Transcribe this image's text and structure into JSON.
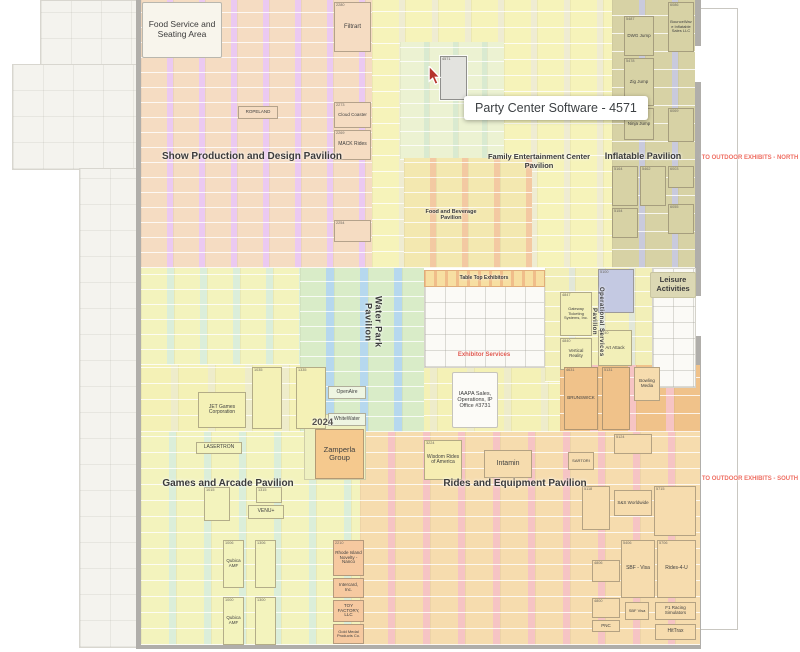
{
  "tooltip": {
    "text": "Party Center Software - 4571"
  },
  "colors": {
    "outdoor_label_red": "#ef6f63",
    "exhibitor_services_red": "#e05a50",
    "wall_gray": "#b0aeaa",
    "selected_booth": "#e3e3df",
    "tooltip_bg": "#ffffff"
  },
  "structure": {
    "concourse": [
      {
        "x": 40,
        "y": 0,
        "w": 98,
        "h": 66
      },
      {
        "x": 12,
        "y": 64,
        "w": 126,
        "h": 106
      },
      {
        "x": 79,
        "y": 168,
        "w": 59,
        "h": 480
      }
    ],
    "walls": [
      {
        "x": 136,
        "y": 0,
        "w": 5,
        "h": 649
      },
      {
        "x": 695,
        "y": 0,
        "w": 6,
        "h": 649
      },
      {
        "x": 136,
        "y": 644,
        "w": 565,
        "h": 5
      }
    ],
    "doors": [
      {
        "x": 695,
        "y": 46,
        "w": 6,
        "h": 36
      },
      {
        "x": 676,
        "y": 46,
        "w": 19,
        "h": 36
      },
      {
        "x": 695,
        "y": 296,
        "w": 6,
        "h": 40
      }
    ],
    "lines": [
      {
        "x": 737,
        "y": 8,
        "w": 1,
        "h": 622
      },
      {
        "x": 701,
        "y": 8,
        "w": 36,
        "h": 1
      },
      {
        "x": 701,
        "y": 629,
        "w": 36,
        "h": 1
      }
    ]
  },
  "regions": [
    {
      "id": "show-production-design",
      "x": 141,
      "y": 0,
      "w": 231,
      "h": 268,
      "bg": "#ebc9f1",
      "booth": "#f5dcc2",
      "cw": 26,
      "gap": 6,
      "rh": 15
    },
    {
      "id": "family-entertainment",
      "x": 372,
      "y": 0,
      "w": 240,
      "h": 268,
      "bg": "#efecd2",
      "booth": "#f6f3ba",
      "cw": 27,
      "gap": 6,
      "rh": 16
    },
    {
      "id": "fec-green",
      "x": 400,
      "y": 42,
      "w": 104,
      "h": 118,
      "bg": "#d9ead0",
      "booth": "#ecf2d2",
      "cw": 24,
      "gap": 5,
      "rh": 14
    },
    {
      "id": "inflatable",
      "x": 612,
      "y": 0,
      "w": 83,
      "h": 268,
      "bg": "#c9cadc",
      "booth": "#d7d2a5",
      "cw": 27,
      "gap": 6,
      "rh": 18
    },
    {
      "id": "food-beverage",
      "x": 404,
      "y": 158,
      "w": 128,
      "h": 110,
      "bg": "#f3c9a2",
      "booth": "#f3e8b0",
      "cw": 26,
      "gap": 6,
      "rh": 15
    },
    {
      "id": "games-upper",
      "x": 141,
      "y": 268,
      "w": 159,
      "h": 97,
      "bg": "#dbeeda",
      "booth": "#f3f3bd",
      "cw": 26,
      "gap": 7,
      "rh": 15
    },
    {
      "id": "mid-yellow-band",
      "x": 141,
      "y": 365,
      "w": 419,
      "h": 67,
      "bg": "#eeecca",
      "booth": "#f4f1b6",
      "cw": 30,
      "gap": 7,
      "rh": 16
    },
    {
      "id": "water-park",
      "x": 300,
      "y": 268,
      "w": 124,
      "h": 164,
      "bg": "#b6d8ee",
      "booth": "#d9ecc8",
      "cw": 26,
      "gap": 8,
      "rh": 15
    },
    {
      "id": "operational-services",
      "x": 545,
      "y": 268,
      "w": 107,
      "h": 114,
      "bg": "#e2e7d8",
      "booth": "#f2efb8",
      "cw": 24,
      "gap": 6,
      "rh": 15
    },
    {
      "id": "rides-upper-right",
      "x": 560,
      "y": 365,
      "w": 140,
      "h": 67,
      "bg": "#f6c4c4",
      "booth": "#f0c28a",
      "cw": 30,
      "gap": 8,
      "rh": 18
    },
    {
      "id": "games-arcade",
      "x": 141,
      "y": 432,
      "w": 219,
      "h": 213,
      "bg": "#dbeeda",
      "booth": "#f3f3bd",
      "cw": 28,
      "gap": 7,
      "rh": 16
    },
    {
      "id": "rides-equipment",
      "x": 360,
      "y": 432,
      "w": 340,
      "h": 213,
      "bg": "#f6c4c4",
      "booth": "#f6dcae",
      "cw": 28,
      "gap": 7,
      "rh": 16
    }
  ],
  "white_areas": [
    {
      "id": "exhibitor-services-plan",
      "cls": "plan-area",
      "x": 424,
      "y": 270,
      "w": 121,
      "h": 98
    },
    {
      "id": "table-top-strip",
      "cls": "strip",
      "x": 424,
      "y": 270,
      "w": 121,
      "h": 17
    },
    {
      "id": "leisure-plan",
      "cls": "plan-area",
      "x": 652,
      "y": 268,
      "w": 44,
      "h": 120
    },
    {
      "id": "zamperla-block",
      "cls": "block",
      "x": 304,
      "y": 414,
      "w": 62,
      "h": 66
    }
  ],
  "booths": [
    {
      "num": "2280",
      "name": "Filtrart",
      "x": 334,
      "y": 2,
      "w": 37,
      "h": 50,
      "bg": "#f5dcc2",
      "fs": 6
    },
    {
      "num": "2273",
      "name": "Cloud Coaster",
      "x": 334,
      "y": 102,
      "w": 37,
      "h": 26,
      "bg": "#f5dcc2",
      "fs": 4.5
    },
    {
      "num": "2269",
      "name": "MACK Rides",
      "x": 334,
      "y": 130,
      "w": 37,
      "h": 30,
      "bg": "#f5dcc2",
      "fs": 5
    },
    {
      "name": "ROPELAND",
      "x": 238,
      "y": 106,
      "w": 40,
      "h": 13,
      "bg": "#f5dcc2",
      "fs": 4.5
    },
    {
      "num": "2254",
      "x": 334,
      "y": 220,
      "w": 37,
      "h": 22,
      "bg": "#f5dcc2"
    },
    {
      "num": "6086",
      "name": "BounceWave Inflatable Sales LLC",
      "x": 668,
      "y": 2,
      "w": 26,
      "h": 50,
      "bg": "#d7d2a5",
      "fs": 4
    },
    {
      "num": "5487",
      "name": "DWG Jump",
      "x": 624,
      "y": 16,
      "w": 30,
      "h": 40,
      "bg": "#d7d2a5",
      "fs": 4.5
    },
    {
      "num": "5478",
      "name": "Zig Jump",
      "x": 624,
      "y": 58,
      "w": 30,
      "h": 48,
      "bg": "#d7d2a5",
      "fs": 4.5
    },
    {
      "num": "5471",
      "name": "Ninja Jump",
      "x": 624,
      "y": 108,
      "w": 30,
      "h": 32,
      "bg": "#d7d2a5",
      "fs": 4.5
    },
    {
      "num": "6069",
      "x": 668,
      "y": 108,
      "w": 26,
      "h": 34,
      "bg": "#d7d2a5"
    },
    {
      "num": "5164",
      "x": 612,
      "y": 166,
      "w": 26,
      "h": 40,
      "bg": "#d7d2a5"
    },
    {
      "num": "5462",
      "x": 640,
      "y": 166,
      "w": 26,
      "h": 40,
      "bg": "#d7d2a5"
    },
    {
      "num": "6003",
      "x": 668,
      "y": 166,
      "w": 26,
      "h": 22,
      "bg": "#d7d2a5"
    },
    {
      "num": "6055",
      "x": 668,
      "y": 204,
      "w": 26,
      "h": 30,
      "bg": "#d7d2a5"
    },
    {
      "num": "5154",
      "x": 612,
      "y": 208,
      "w": 26,
      "h": 30,
      "bg": "#d7d2a5"
    },
    {
      "num": "4571",
      "x": 440,
      "y": 56,
      "w": 27,
      "h": 44,
      "bg": "#e3e3df",
      "sel": true
    },
    {
      "name": "OpenAire",
      "x": 328,
      "y": 386,
      "w": 38,
      "h": 13,
      "bg": "#eef5e2",
      "fs": 5
    },
    {
      "name": "Embed",
      "x": 300,
      "y": 400,
      "w": 26,
      "h": 11,
      "bg": "#eef5e2",
      "fs": 4.5
    },
    {
      "name": "WhiteWater",
      "x": 328,
      "y": 413,
      "w": 38,
      "h": 13,
      "bg": "#eef5e2",
      "fs": 5
    },
    {
      "name": "JET Games Corporation",
      "x": 198,
      "y": 392,
      "w": 48,
      "h": 36,
      "bg": "#f4f1b6",
      "fs": 5
    },
    {
      "num": "1035",
      "x": 252,
      "y": 367,
      "w": 30,
      "h": 62,
      "bg": "#f4f1b6"
    },
    {
      "num": "1335",
      "x": 296,
      "y": 367,
      "w": 30,
      "h": 62,
      "bg": "#f4f1b6"
    },
    {
      "num": "4847",
      "name": "Gateway Ticketing Systems, Inc.",
      "x": 560,
      "y": 292,
      "w": 32,
      "h": 44,
      "bg": "#f2efb8",
      "fs": 4
    },
    {
      "num": "4840",
      "name": "Vertical Reality",
      "x": 560,
      "y": 338,
      "w": 32,
      "h": 32,
      "bg": "#f2efb8",
      "fs": 4.5
    },
    {
      "num": "5100",
      "x": 598,
      "y": 269,
      "w": 36,
      "h": 44,
      "bg": "#c4c9e2"
    },
    {
      "num": "5140",
      "name": "Art Attack",
      "x": 598,
      "y": 330,
      "w": 34,
      "h": 36,
      "bg": "#f2efb8",
      "fs": 4.5
    },
    {
      "num": "4631",
      "name": "BRUNSWICK",
      "x": 564,
      "y": 367,
      "w": 34,
      "h": 63,
      "bg": "#f0c28a",
      "fs": 4.5
    },
    {
      "num": "5131",
      "x": 602,
      "y": 367,
      "w": 28,
      "h": 63,
      "bg": "#f0c28a"
    },
    {
      "name": "Bowling Media",
      "x": 634,
      "y": 367,
      "w": 26,
      "h": 34,
      "bg": "#f6dcae",
      "fs": 4.5
    },
    {
      "name": "LASERTRON",
      "x": 196,
      "y": 442,
      "w": 46,
      "h": 12,
      "bg": "#f3f3bd",
      "fs": 5
    },
    {
      "num": "1015",
      "x": 204,
      "y": 487,
      "w": 26,
      "h": 34,
      "bg": "#f3f3bd"
    },
    {
      "num": "1315",
      "x": 256,
      "y": 487,
      "w": 26,
      "h": 16,
      "bg": "#f3f3bd"
    },
    {
      "name": "VENU+",
      "x": 248,
      "y": 505,
      "w": 36,
      "h": 14,
      "bg": "#f3f3bd",
      "fs": 5
    },
    {
      "num": "1006",
      "name": "QubicaAMF",
      "x": 223,
      "y": 540,
      "w": 21,
      "h": 48,
      "bg": "#f3f3bd",
      "fs": 4.5
    },
    {
      "num": "1306",
      "x": 255,
      "y": 540,
      "w": 21,
      "h": 48,
      "bg": "#f3f3bd"
    },
    {
      "num": "1000",
      "name": "QubicaAMF",
      "x": 223,
      "y": 597,
      "w": 21,
      "h": 48,
      "bg": "#f3f3bd",
      "fs": 4.5
    },
    {
      "num": "1300",
      "x": 255,
      "y": 597,
      "w": 21,
      "h": 48,
      "bg": "#f3f3bd"
    },
    {
      "num": "2210",
      "name": "Rhode Island Novelty - Nanco",
      "x": 333,
      "y": 540,
      "w": 31,
      "h": 36,
      "bg": "#f6c9a0",
      "fs": 4.5
    },
    {
      "name": "Intercard, Inc.",
      "x": 333,
      "y": 578,
      "w": 31,
      "h": 20,
      "bg": "#f6c9a0",
      "fs": 4.5
    },
    {
      "name": "TOY FACTORY, LLC",
      "x": 333,
      "y": 600,
      "w": 31,
      "h": 22,
      "bg": "#f6c9a0",
      "fs": 4.5
    },
    {
      "name": "Gold Medal Products Co.",
      "x": 333,
      "y": 624,
      "w": 31,
      "h": 20,
      "bg": "#f6c9a0",
      "fs": 4
    },
    {
      "name": "Zamperla Group",
      "x": 315,
      "y": 429,
      "w": 49,
      "h": 50,
      "bg": "#f5c98e",
      "fs": 7.5
    },
    {
      "num": "3224",
      "name": "Wisdom Rides of America",
      "x": 424,
      "y": 440,
      "w": 38,
      "h": 40,
      "bg": "#f6edb2",
      "fs": 5
    },
    {
      "name": "Intamin",
      "x": 484,
      "y": 450,
      "w": 48,
      "h": 28,
      "bg": "#f6dcae",
      "fs": 7
    },
    {
      "name": "SARTORI",
      "x": 568,
      "y": 452,
      "w": 26,
      "h": 18,
      "bg": "#f6dcae",
      "fs": 4
    },
    {
      "num": "5118",
      "x": 582,
      "y": 486,
      "w": 28,
      "h": 44,
      "bg": "#f6dcae"
    },
    {
      "num": "5715",
      "x": 654,
      "y": 486,
      "w": 42,
      "h": 50,
      "bg": "#f6dcae"
    },
    {
      "num": "5124",
      "x": 614,
      "y": 434,
      "w": 38,
      "h": 20,
      "bg": "#f6dcae"
    },
    {
      "name": "S&S Worldwide",
      "x": 614,
      "y": 490,
      "w": 38,
      "h": 26,
      "bg": "#f6dcae",
      "fs": 4.5
    },
    {
      "num": "5406",
      "name": "SBF - Visa",
      "x": 621,
      "y": 540,
      "w": 34,
      "h": 58,
      "bg": "#f6dcae",
      "fs": 5
    },
    {
      "num": "5706",
      "name": "Rides-4-U",
      "x": 657,
      "y": 540,
      "w": 39,
      "h": 58,
      "bg": "#f6dcae",
      "fs": 5
    },
    {
      "name": "SBF Visa",
      "x": 625,
      "y": 602,
      "w": 24,
      "h": 18,
      "bg": "#f6dcae",
      "fs": 4
    },
    {
      "name": "F1 Racing Simulators",
      "x": 655,
      "y": 602,
      "w": 41,
      "h": 18,
      "bg": "#f6dcae",
      "fs": 4.5
    },
    {
      "name": "HitTrax",
      "x": 655,
      "y": 624,
      "w": 41,
      "h": 16,
      "bg": "#f6dcae",
      "fs": 5
    },
    {
      "num": "4806",
      "x": 592,
      "y": 560,
      "w": 28,
      "h": 22,
      "bg": "#f6dcae"
    },
    {
      "num": "4800",
      "x": 592,
      "y": 598,
      "w": 28,
      "h": 20,
      "bg": "#f6dcae"
    },
    {
      "name": "PNC",
      "x": 592,
      "y": 620,
      "w": 28,
      "h": 12,
      "bg": "#f6dcae",
      "fs": 4.5
    }
  ],
  "labels": [
    {
      "id": "show-production-design",
      "text": "Show Production and Design Pavilion",
      "x": 158,
      "y": 151,
      "w": 188,
      "fs": 10,
      "fw": 600
    },
    {
      "id": "family-entertainment",
      "text": "Family Entertainment Center Pavilion",
      "x": 477,
      "y": 153,
      "w": 124,
      "fs": 7.5,
      "fw": 600
    },
    {
      "id": "inflatable",
      "text": "Inflatable Pavilion",
      "x": 604,
      "y": 151,
      "w": 78,
      "fs": 9,
      "fw": 700
    },
    {
      "id": "food-beverage",
      "text": "Food and Beverage Pavilion",
      "x": 416,
      "y": 209,
      "w": 70,
      "fs": 5.5,
      "fw": 600
    },
    {
      "id": "water-park",
      "text": "Water Park Pavilion",
      "x": 363,
      "y": 276,
      "h": 92,
      "fs": 9,
      "fw": 600,
      "vertical": true
    },
    {
      "id": "operational-services",
      "text": "Operational Services Pavilion",
      "x": 590,
      "y": 280,
      "h": 84,
      "fs": 6,
      "fw": 600,
      "vertical": true
    },
    {
      "id": "table-top",
      "text": "Table Top Exhibitors",
      "x": 428,
      "y": 276,
      "w": 112,
      "fs": 5,
      "fw": 600
    },
    {
      "id": "exhibitor-services",
      "text": "Exhibitor Services",
      "x": 428,
      "y": 352,
      "w": 112,
      "fs": 6,
      "fw": 700,
      "color": "#e05a50"
    },
    {
      "id": "games-arcade",
      "text": "Games and Arcade Pavilion",
      "x": 158,
      "y": 478,
      "w": 140,
      "fs": 10,
      "fw": 600
    },
    {
      "id": "rides-equipment",
      "text": "Rides and Equipment Pavilion",
      "x": 440,
      "y": 478,
      "w": 150,
      "fs": 10,
      "fw": 600
    },
    {
      "id": "outdoor-north",
      "text": "TO OUTDOOR EXHIBITS - NORTH",
      "x": 700,
      "y": 155,
      "w": 100,
      "fs": 6,
      "fw": 700,
      "color": "#ef6f63",
      "nw": true
    },
    {
      "id": "outdoor-south",
      "text": "TO OUTDOOR EXHIBITS - SOUTH",
      "x": 700,
      "y": 476,
      "w": 100,
      "fs": 6,
      "fw": 700,
      "color": "#ef6f63",
      "nw": true
    },
    {
      "id": "year",
      "text": "2024",
      "x": 312,
      "y": 418,
      "w": 36,
      "fs": 9.5,
      "fw": 600,
      "color": "#55524e",
      "ta": "left"
    },
    {
      "id": "food-service",
      "text": "Food Service and Seating Area",
      "x": 142,
      "y": 2,
      "w": 80,
      "h": 56,
      "fs": 8.5,
      "fw": 400,
      "box": true,
      "bg": "#f8f5ec",
      "bd": "#b9b7ae"
    },
    {
      "id": "leisure",
      "text": "Leisure Activities",
      "x": 650,
      "y": 272,
      "w": 46,
      "h": 26,
      "fs": 7.5,
      "fw": 600,
      "box": true,
      "bg": "#dcd8b4",
      "bd": "#c8c4a0"
    },
    {
      "id": "iaapa-office",
      "text": "IAAPA Sales, Operations, IP Office #3731",
      "x": 452,
      "y": 372,
      "w": 46,
      "h": 56,
      "fs": 5.5,
      "fw": 400,
      "box": true,
      "bg": "#fcfbf7",
      "bd": "#c6c4bc"
    }
  ]
}
